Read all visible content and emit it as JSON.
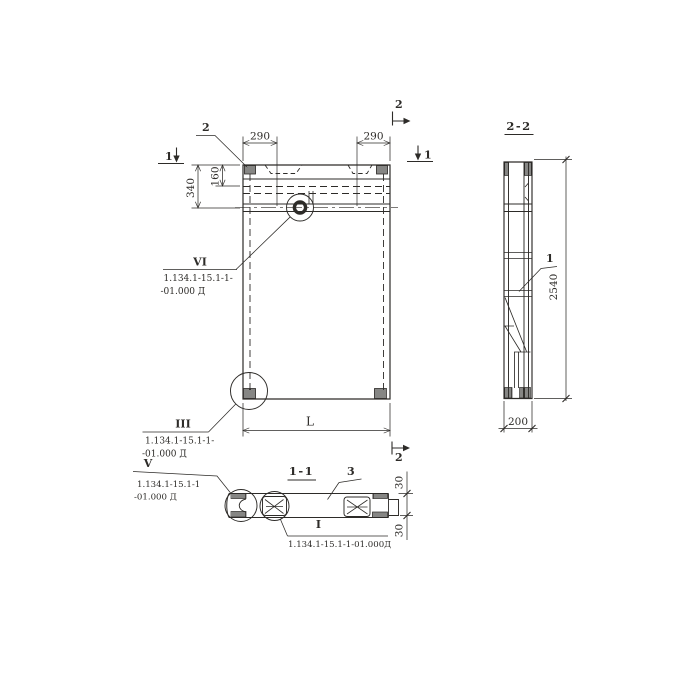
{
  "page": {
    "background": "#ffffff",
    "ink": "#2d2b28",
    "kind": "precast-panel-working-drawing"
  },
  "plan": {
    "dim_290_left": "290",
    "dim_290_right": "290",
    "dim_340": "340",
    "dim_160": "160",
    "dim_length": "L",
    "mark_1_left": "1",
    "mark_1_right": "1",
    "mark_2_top": "2",
    "mark_2_bottom": "2",
    "callout_2": "2",
    "detail_vi": {
      "numeral": "VI",
      "ref1": "1.134.1-15.1-1-",
      "ref2": "-01.000 Д"
    },
    "detail_iii": {
      "numeral": "III",
      "ref1": "1.134.1-15.1-1-",
      "ref2": "-01.000 Д"
    }
  },
  "section22": {
    "title": "2-2",
    "dim_height": "2540",
    "dim_width": "200",
    "callout_1": "1"
  },
  "section11": {
    "title": "1-1",
    "callout_3": "3",
    "dim_30_top": "30",
    "dim_30_bottom": "30",
    "detail_v": {
      "numeral": "V",
      "ref1": "1.134.1-15.1-1",
      "ref2": "-01.000 Д"
    },
    "detail_i": {
      "numeral": "I",
      "ref": "1.134.1-15.1-1-01.000Д"
    }
  }
}
